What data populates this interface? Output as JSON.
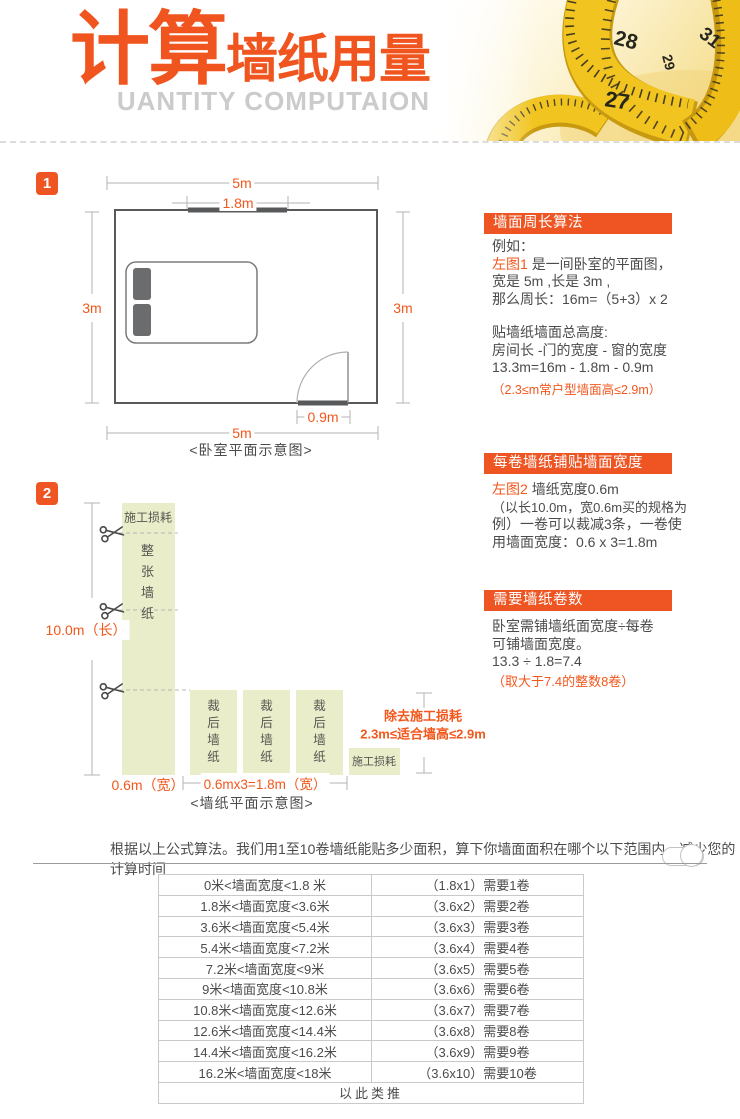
{
  "colors": {
    "accent_box": "#ee5523",
    "accent_text": "#f2571c",
    "strip_green": "#e9edca",
    "wall": "#58595b"
  },
  "header": {
    "title_big": "计算",
    "title_small": "墙纸用量",
    "subtitle": "UANTITY COMPUTAION",
    "tape_numbers": [
      "28",
      "31",
      "29",
      "27"
    ]
  },
  "section1": {
    "badge": "1",
    "dim_top": "5m",
    "dim_window": "1.8m",
    "dim_left": "3m",
    "dim_right": "3m",
    "dim_door": "0.9m",
    "dim_bottom": "5m",
    "caption": "<卧室平面示意图>"
  },
  "panel1": {
    "title": "墙面周长算法",
    "intro": "例如：",
    "ref": "左图1",
    "ref_rest": "是一间卧室的平面图，",
    "line_size": "宽是 5m ,长是 3m ,",
    "line_perimeter": "那么周长：16m=（5+3）x 2",
    "sub_title": "贴墙纸墙面总高度:",
    "sub_formula": "房间长 -门的宽度 - 窗的宽度",
    "sub_result": "13.3m=16m - 1.8m - 0.9m",
    "note": "（2.3≤m常户型墙面高≤2.9m）"
  },
  "section2": {
    "badge": "2",
    "strip_top_label": "施工损耗",
    "strip_main_label": "整张墙纸",
    "cut_strip_label": "裁后墙纸",
    "loss_box_label": "施工损耗",
    "dim_length": "10.0m（长）",
    "dim_width": "0.6m（宽）",
    "dim_total_width": "0.6mx3=1.8m（宽）",
    "note_line1": "除去施工损耗",
    "note_line2": "2.3m≤适合墙高≤2.9m",
    "caption": "<墙纸平面示意图>"
  },
  "panel2": {
    "title": "每卷墙纸铺贴墙面宽度",
    "ref": "左图2",
    "ref_rest": "墙纸宽度0.6m",
    "line2": "（以长10.0m，宽0.6m买的规格为",
    "line3": "例）一卷可以裁减3条，一卷使",
    "line4": "用墙面宽度：0.6 x 3=1.8m"
  },
  "panel3": {
    "title": "需要墙纸卷数",
    "line1": "卧室需铺墙纸面宽度÷每卷",
    "line2": "可铺墙面宽度。",
    "line3": "13.3 ÷ 1.8=7.4",
    "note": "（取大于7.4的整数8卷）"
  },
  "bottom": {
    "intro": "根据以上公式算法。我们用1至10卷墙纸能贴多少面积，算下你墙面面积在哪个以下范围内，减少您的计算时间",
    "table": {
      "rows": [
        {
          "range": "0米<墙面宽度<1.8 米",
          "rolls": "（1.8x1）需要1卷"
        },
        {
          "range": "1.8米<墙面宽度<3.6米",
          "rolls": "（3.6x2）需要2卷"
        },
        {
          "range": "3.6米<墙面宽度<5.4米",
          "rolls": "（3.6x3）需要3卷"
        },
        {
          "range": "5.4米<墙面宽度<7.2米",
          "rolls": "（3.6x4）需要4卷"
        },
        {
          "range": "7.2米<墙面宽度<9米",
          "rolls": "（3.6x5）需要5卷"
        },
        {
          "range": "9米<墙面宽度<10.8米",
          "rolls": "（3.6x6）需要6卷"
        },
        {
          "range": "10.8米<墙面宽度<12.6米",
          "rolls": "（3.6x7）需要7卷"
        },
        {
          "range": "12.6米<墙面宽度<14.4米",
          "rolls": "（3.6x8）需要8卷"
        },
        {
          "range": "14.4米<墙面宽度<16.2米",
          "rolls": "（3.6x9）需要9卷"
        },
        {
          "range": "16.2米<墙面宽度<18米",
          "rolls": "（3.6x10）需要10卷"
        }
      ],
      "footer": "以此类推"
    }
  }
}
